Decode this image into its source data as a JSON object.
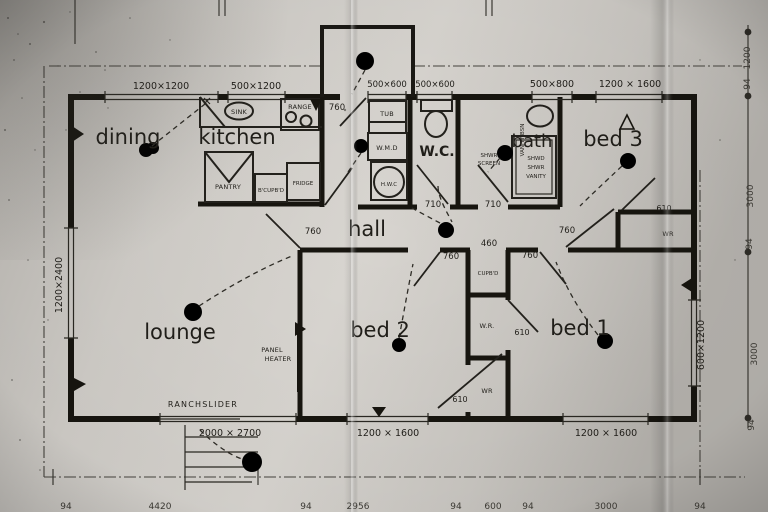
{
  "rooms": {
    "dining": "dining",
    "kitchen": "kitchen",
    "wc": "W.C.",
    "bath": "bath",
    "bed3": "bed 3",
    "hall": "hall",
    "lounge": "lounge",
    "bed2": "bed 2",
    "bed1": "bed 1"
  },
  "fixtures": {
    "sink": "SINK",
    "range": "RANGE",
    "pantry": "PANTRY",
    "broom_cupboard": "B'CUPB'D",
    "fridge": "FRIDGE",
    "tub": "TUB",
    "washing_machine": "W.M.D",
    "hot_water_cylinder": "H.W.C",
    "hall_cupboard": "CUPB'D",
    "wardrobe_bed3": "WR",
    "wardrobe_bed1": "W.R.",
    "wardrobe_bed2": "WR",
    "vanity_basin": "VANITY BSN",
    "shower_screen_line1": "SHWR",
    "shower_screen_line2": "SCREEN",
    "shower_box_line1": "SHWD",
    "shower_box_line2": "SHWR",
    "shower_box_line3": "VANITY",
    "panel_heater_line1": "PANEL",
    "panel_heater_line2": "HEATER",
    "ranchslider": "RANCHSLIDER"
  },
  "window_dims": {
    "dining_top": "1200×1200",
    "kitchen_top": "500×1200",
    "laundry_top": "500×600",
    "wc_top": "500×600",
    "bath_top": "500×800",
    "bed3_top": "1200 × 1600",
    "lounge_left": "1200×2400",
    "bed1_right": "600×1200",
    "lounge_ranchslider": "2000 × 2700",
    "bed2_bottom": "1200 × 1600",
    "bed1_bottom": "1200 × 1600"
  },
  "door_widths": {
    "entry": "760",
    "wc": "710",
    "bath": "710",
    "hall_west": "760",
    "bed3": "760",
    "bed2": "760",
    "bed1": "760"
  },
  "storage_dims": {
    "hall_cupboard": "460",
    "bed3_wr": "610",
    "bed1_wr": "610",
    "bed2_wr": "610"
  },
  "overall_dims": {
    "right": [
      "1200",
      "94",
      "3000",
      "94",
      "3000",
      "94"
    ],
    "bottom": [
      "94",
      "4420",
      "94",
      "2956",
      "94",
      "600",
      "94",
      "3000",
      "94"
    ]
  }
}
